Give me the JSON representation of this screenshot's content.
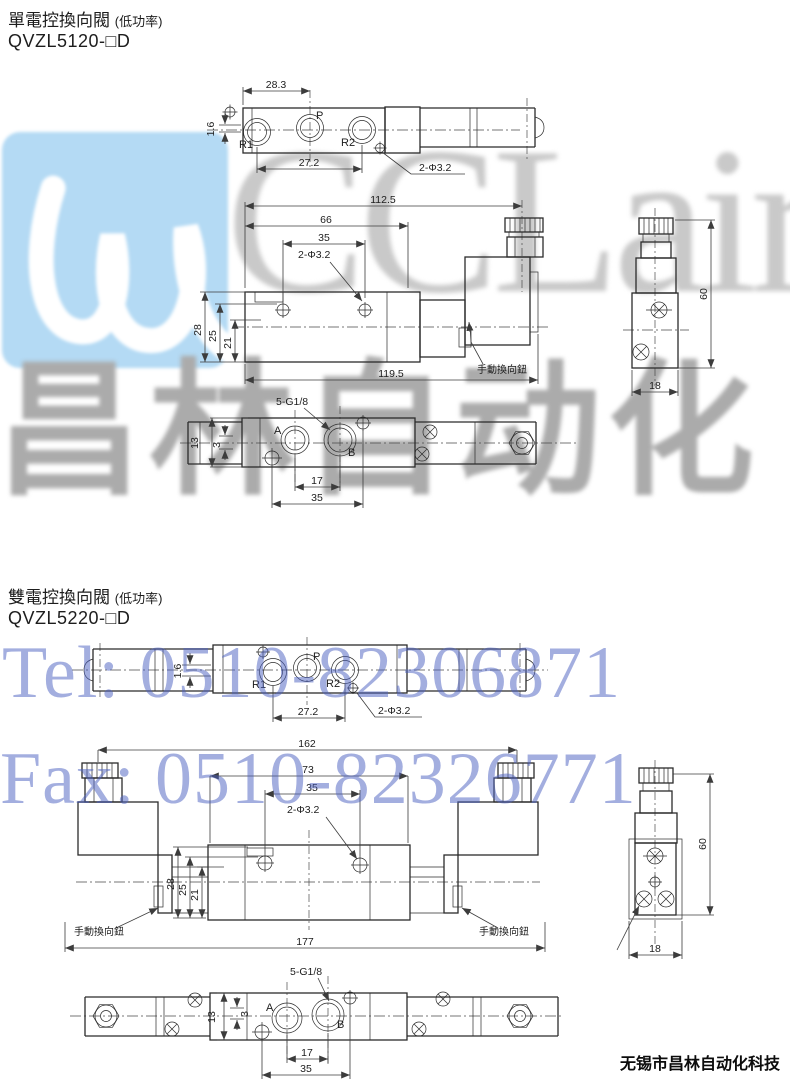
{
  "watermarks": {
    "logo_text": "CCLair",
    "brand_text": "昌林自动化",
    "tel_text": "Tel: 0510-82306871",
    "fax_text": "Fax: 0510-82326771",
    "blue_color": "#4a5fc0",
    "gray_color": "#c9c9c9",
    "logo_square_color": "#b4daf4"
  },
  "footer": {
    "company": "无锡市昌林自动化科技"
  },
  "section1": {
    "title": "單電控換向閥",
    "title_note": "(低功率)",
    "model": "QVZL5120-□D",
    "top_view": {
      "dim_28_3": "28.3",
      "dim_1_6": "1.6",
      "dim_27_2": "27.2",
      "callout_holes": "2-Φ3.2",
      "port_r1": "R1",
      "port_p": "P",
      "port_r2": "R2"
    },
    "front_view": {
      "dim_112_5": "112.5",
      "dim_66": "66",
      "dim_35": "35",
      "callout_holes": "2-Φ3.2",
      "dim_28": "28",
      "dim_25": "25",
      "dim_21": "21",
      "dim_119_5": "119.5",
      "manual_label": "手動換向鈕"
    },
    "side_view": {
      "dim_60": "60",
      "dim_18": "18"
    },
    "bottom_view": {
      "callout_thread": "5-G1/8",
      "port_a": "A",
      "port_b": "B",
      "dim_13": "13",
      "dim_3": "3",
      "dim_17": "17",
      "dim_35": "35"
    }
  },
  "section2": {
    "title": "雙電控換向閥",
    "title_note": "(低功率)",
    "model": "QVZL5220-□D",
    "top_view": {
      "dim_1_6": "1.6",
      "dim_27_2": "27.2",
      "callout_holes": "2-Φ3.2",
      "port_r1": "R1",
      "port_p": "P",
      "port_r2": "R2"
    },
    "front_view": {
      "dim_162": "162",
      "dim_73": "73",
      "dim_35": "35",
      "callout_holes": "2-Φ3.2",
      "dim_28": "28",
      "dim_25": "25",
      "dim_21": "21",
      "dim_177": "177",
      "manual_label_left": "手動換向鈕",
      "manual_label_right": "手動換向鈕"
    },
    "side_view": {
      "dim_60": "60",
      "dim_18": "18"
    },
    "bottom_view": {
      "callout_thread": "5-G1/8",
      "port_a": "A",
      "port_b": "B",
      "dim_13": "13",
      "dim_3": "3",
      "dim_17": "17",
      "dim_35": "35"
    }
  }
}
